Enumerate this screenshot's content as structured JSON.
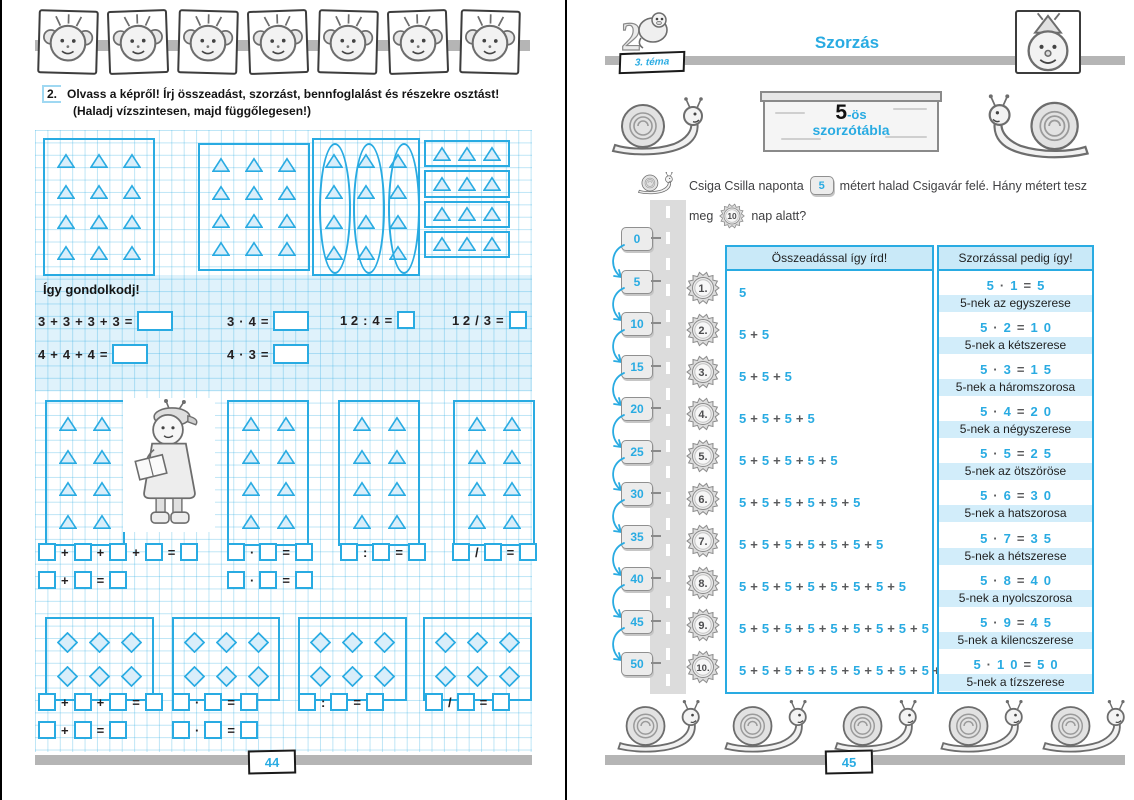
{
  "accent": "#29abe2",
  "left_page": {
    "portraits": [
      "elephant",
      "spiky-boy",
      "monkey",
      "girl",
      "owl",
      "glasses-kid",
      "dragon"
    ],
    "exercise_number": "2.",
    "instruction_line1": "Olvass a képről! Írj összeadást, szorzást, bennfoglalást és részekre osztást!",
    "instruction_line2": "(Haladj vízszintesen, majd függőlegesen!)",
    "top_boxes": [
      {
        "shape": "triangle",
        "rows": 4,
        "cols": 3,
        "variant": "plain"
      },
      {
        "shape": "triangle",
        "rows": 4,
        "cols": 3,
        "variant": "plain"
      },
      {
        "shape": "triangle",
        "rows": 4,
        "cols": 3,
        "variant": "ovals"
      },
      {
        "shape": "triangle",
        "rows": 4,
        "cols": 3,
        "variant": "rows"
      }
    ],
    "think": {
      "title": "Így gondolkodj!",
      "row1": [
        [
          "3",
          "+",
          "3",
          "+",
          "3",
          "+",
          "3",
          "=",
          "BW"
        ],
        [
          "3",
          "·",
          "4",
          "=",
          "BW"
        ],
        [
          "1 2",
          ":",
          "4",
          "=",
          "B"
        ],
        [
          "1 2",
          "/",
          "3",
          "=",
          "B"
        ]
      ],
      "row2": [
        [
          "4",
          "+",
          "4",
          "+",
          "4",
          "=",
          "BW"
        ],
        [
          "4",
          "·",
          "3",
          "=",
          "BW"
        ]
      ]
    },
    "mid_boxes": [
      {
        "shape": "triangle",
        "rows": 4,
        "cols": 2,
        "variant": "plain"
      },
      {
        "shape": "triangle",
        "rows": 4,
        "cols": 2,
        "variant": "plain"
      },
      {
        "shape": "triangle",
        "rows": 4,
        "cols": 2,
        "variant": "plain"
      },
      {
        "shape": "triangle",
        "rows": 4,
        "cols": 2,
        "variant": "plain"
      }
    ],
    "mid_eq_row1": [
      [
        "B",
        "+",
        "B",
        "+",
        "B",
        "+",
        "B",
        "=",
        "B"
      ],
      [
        "B",
        "·",
        "B",
        "=",
        "B"
      ],
      [
        "B",
        ":",
        "B",
        "=",
        "B"
      ],
      [
        "B",
        "/",
        "B",
        "=",
        "B"
      ]
    ],
    "mid_eq_row2": [
      [
        "B",
        "+",
        "B",
        "=",
        "B"
      ],
      [
        "B",
        "·",
        "B",
        "=",
        "B"
      ]
    ],
    "diamond_boxes": [
      {
        "shape": "diamond",
        "rows": 2,
        "cols": 3,
        "variant": "plain"
      },
      {
        "shape": "diamond",
        "rows": 2,
        "cols": 3,
        "variant": "plain"
      },
      {
        "shape": "diamond",
        "rows": 2,
        "cols": 3,
        "variant": "plain"
      },
      {
        "shape": "diamond",
        "rows": 2,
        "cols": 3,
        "variant": "plain"
      }
    ],
    "bottom_eq_row1": [
      [
        "B",
        "+",
        "B",
        "+",
        "B",
        "=",
        "B"
      ],
      [
        "B",
        "·",
        "B",
        "=",
        "B"
      ],
      [
        "B",
        ":",
        "B",
        "=",
        "B"
      ],
      [
        "B",
        "/",
        "B",
        "=",
        "B"
      ]
    ],
    "bottom_eq_row2": [
      [
        "B",
        "+",
        "B",
        "=",
        "B"
      ],
      [
        "B",
        "·",
        "B",
        "=",
        "B"
      ]
    ],
    "page_number": "44"
  },
  "right_page": {
    "theme_badge": "3. téma",
    "title": "Szorzás",
    "sign_number": "5",
    "sign_suffix": "-ös",
    "sign_word": "szorzótábla",
    "problem_part1": "Csiga Csilla naponta",
    "problem_badge1": "5",
    "problem_part2": "métert halad Csigavár felé. Hány métert tesz",
    "problem_part3": "meg",
    "problem_badge2": "10",
    "problem_part4": "nap alatt?",
    "milestones": [
      "0",
      "5",
      "10",
      "15",
      "20",
      "25",
      "30",
      "35",
      "40",
      "45",
      "50"
    ],
    "table": {
      "left_header": "Összeadással így írd!",
      "right_header": "Szorzással pedig így!",
      "rows": [
        {
          "num": "1.",
          "sum": "5",
          "product": "5 · 1 = 5",
          "label": "5-nek az egyszerese"
        },
        {
          "num": "2.",
          "sum": "5 + 5",
          "product": "5 · 2 = 1 0",
          "label": "5-nek a kétszerese"
        },
        {
          "num": "3.",
          "sum": "5 + 5 + 5",
          "product": "5 · 3 = 1 5",
          "label": "5-nek a háromszorosa"
        },
        {
          "num": "4.",
          "sum": "5 + 5 + 5 + 5",
          "product": "5 · 4 = 2 0",
          "label": "5-nek a négyszerese"
        },
        {
          "num": "5.",
          "sum": "5 + 5 + 5 + 5 + 5",
          "product": "5 · 5 = 2 5",
          "label": "5-nek az ötszöröse"
        },
        {
          "num": "6.",
          "sum": "5 + 5 + 5 + 5 + 5 + 5",
          "product": "5 · 6 = 3 0",
          "label": "5-nek a hatszorosa"
        },
        {
          "num": "7.",
          "sum": "5 + 5 + 5 + 5 + 5 + 5 + 5",
          "product": "5 · 7 = 3 5",
          "label": "5-nek a hétszerese"
        },
        {
          "num": "8.",
          "sum": "5 + 5 + 5 + 5 + 5 + 5 + 5 + 5",
          "product": "5 · 8 = 4 0",
          "label": "5-nek a nyolcszorosa"
        },
        {
          "num": "9.",
          "sum": "5 + 5 + 5 + 5 + 5 + 5 + 5 + 5 + 5",
          "product": "5 · 9 = 4 5",
          "label": "5-nek a kilencszerese"
        },
        {
          "num": "10.",
          "sum": "5 + 5 + 5 + 5 + 5 + 5 + 5 + 5 + 5 + 5",
          "product": "5 · 1 0 = 5 0",
          "label": "5-nek a tízszerese"
        }
      ]
    },
    "page_number": "45"
  }
}
